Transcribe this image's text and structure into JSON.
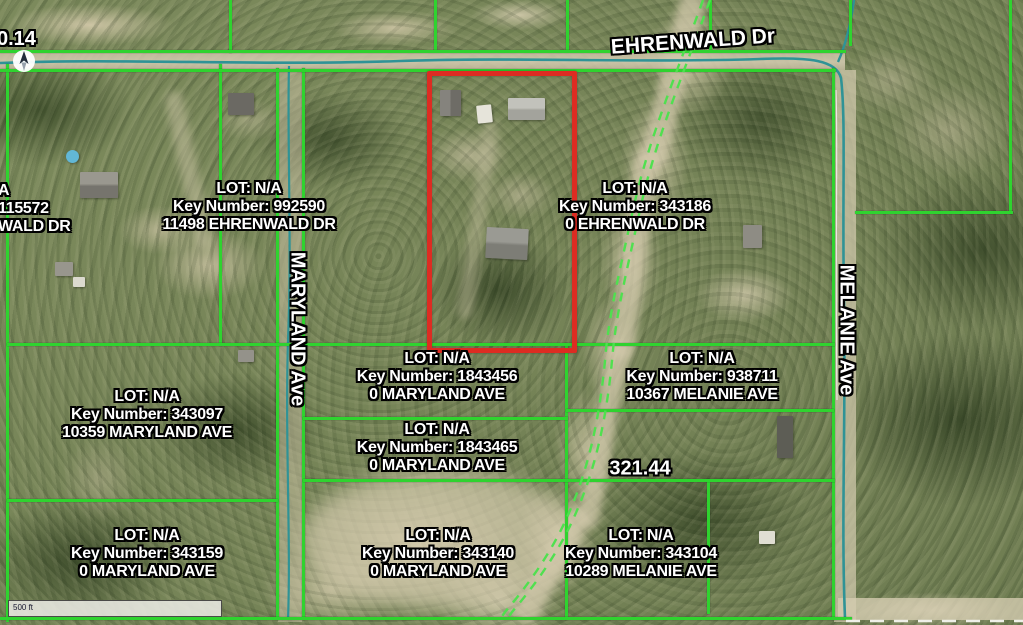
{
  "map": {
    "title": "parcel-aerial-map",
    "streets": {
      "ehrenwald": "EHRENWALD Dr",
      "maryland": "MARYLAND Ave",
      "melanie": "MELANIE Ave"
    },
    "measurements": {
      "top_left": "0.14",
      "mid_right": "321.44"
    },
    "scale_bar": {
      "label": "500 ft"
    },
    "colors": {
      "parcel_line_green": "#2fd32f",
      "selected_parcel_red": "#dd2c22",
      "water_road_teal": "#2f9396"
    },
    "parcels": [
      {
        "id": "cut-left",
        "lot": "A",
        "key": "115572",
        "address": "WALD DR"
      },
      {
        "id": "992590",
        "lot": "LOT: N/A",
        "key": "Key Number: 992590",
        "address": "11498 EHRENWALD DR"
      },
      {
        "id": "343186",
        "lot": "LOT: N/A",
        "key": "Key Number: 343186",
        "address": "0 EHRENWALD DR"
      },
      {
        "id": "1843456",
        "lot": "LOT: N/A",
        "key": "Key Number: 1843456",
        "address": "0 MARYLAND AVE"
      },
      {
        "id": "938711",
        "lot": "LOT: N/A",
        "key": "Key Number: 938711",
        "address": "10367 MELANIE AVE"
      },
      {
        "id": "343097",
        "lot": "LOT: N/A",
        "key": "Key Number: 343097",
        "address": "10359 MARYLAND AVE"
      },
      {
        "id": "1843465",
        "lot": "LOT: N/A",
        "key": "Key Number: 1843465",
        "address": "0 MARYLAND AVE"
      },
      {
        "id": "343159",
        "lot": "LOT: N/A",
        "key": "Key Number: 343159",
        "address": "0 MARYLAND AVE"
      },
      {
        "id": "343140",
        "lot": "LOT: N/A",
        "key": "Key Number: 343140",
        "address": "0 MARYLAND AVE"
      },
      {
        "id": "343104",
        "lot": "LOT: N/A",
        "key": "Key Number: 343104",
        "address": "10289 MELANIE AVE"
      }
    ]
  }
}
